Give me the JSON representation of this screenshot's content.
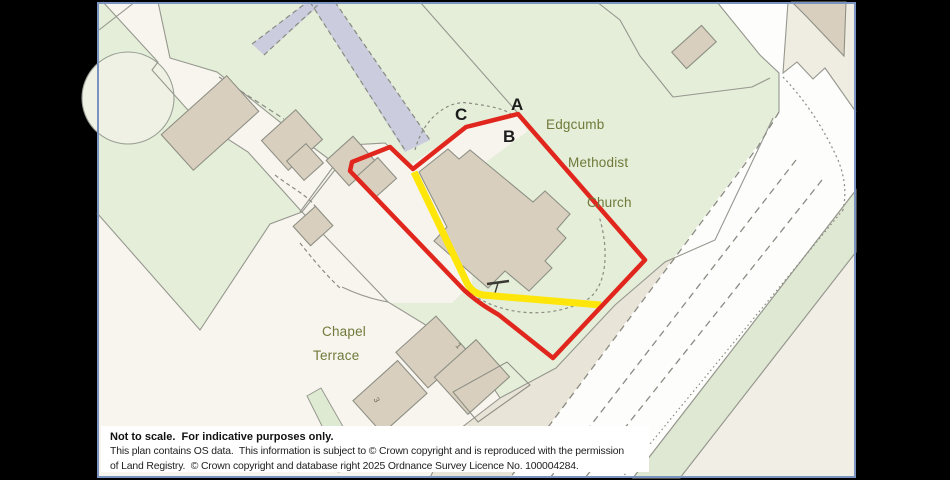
{
  "window": {
    "background": "#000000"
  },
  "map": {
    "border_color": "#7b93c0",
    "point_labels": {
      "a": "A",
      "b": "B",
      "c": "C"
    },
    "place_labels": {
      "church_line1": "Edgcumb",
      "church_line2": "Methodist",
      "church_line3": "Church",
      "terrace_line1": "Chapel",
      "terrace_line2": "Terrace",
      "house_no_1": "1",
      "house_no_3": "3"
    },
    "colors": {
      "boundary_red": "#e1261d",
      "route_yellow": "#ffe60a",
      "greenspace": "#e4eed8",
      "road_white": "#fdfdfb",
      "building_tan": "#d8cfbe",
      "path_lavender": "#cbccdd",
      "label_olive": "#71793a",
      "verge_taupe": "#e9e4d8"
    }
  },
  "notice": {
    "title": "Not to scale.  For indicative purposes only.",
    "line2": "This plan contains OS data.  This information is subject to © Crown copyright and is reproduced with the permission",
    "line3": "of Land Registry.  © Crown copyright and database right 2025 Ordnance Survey Licence No. 100004284."
  }
}
